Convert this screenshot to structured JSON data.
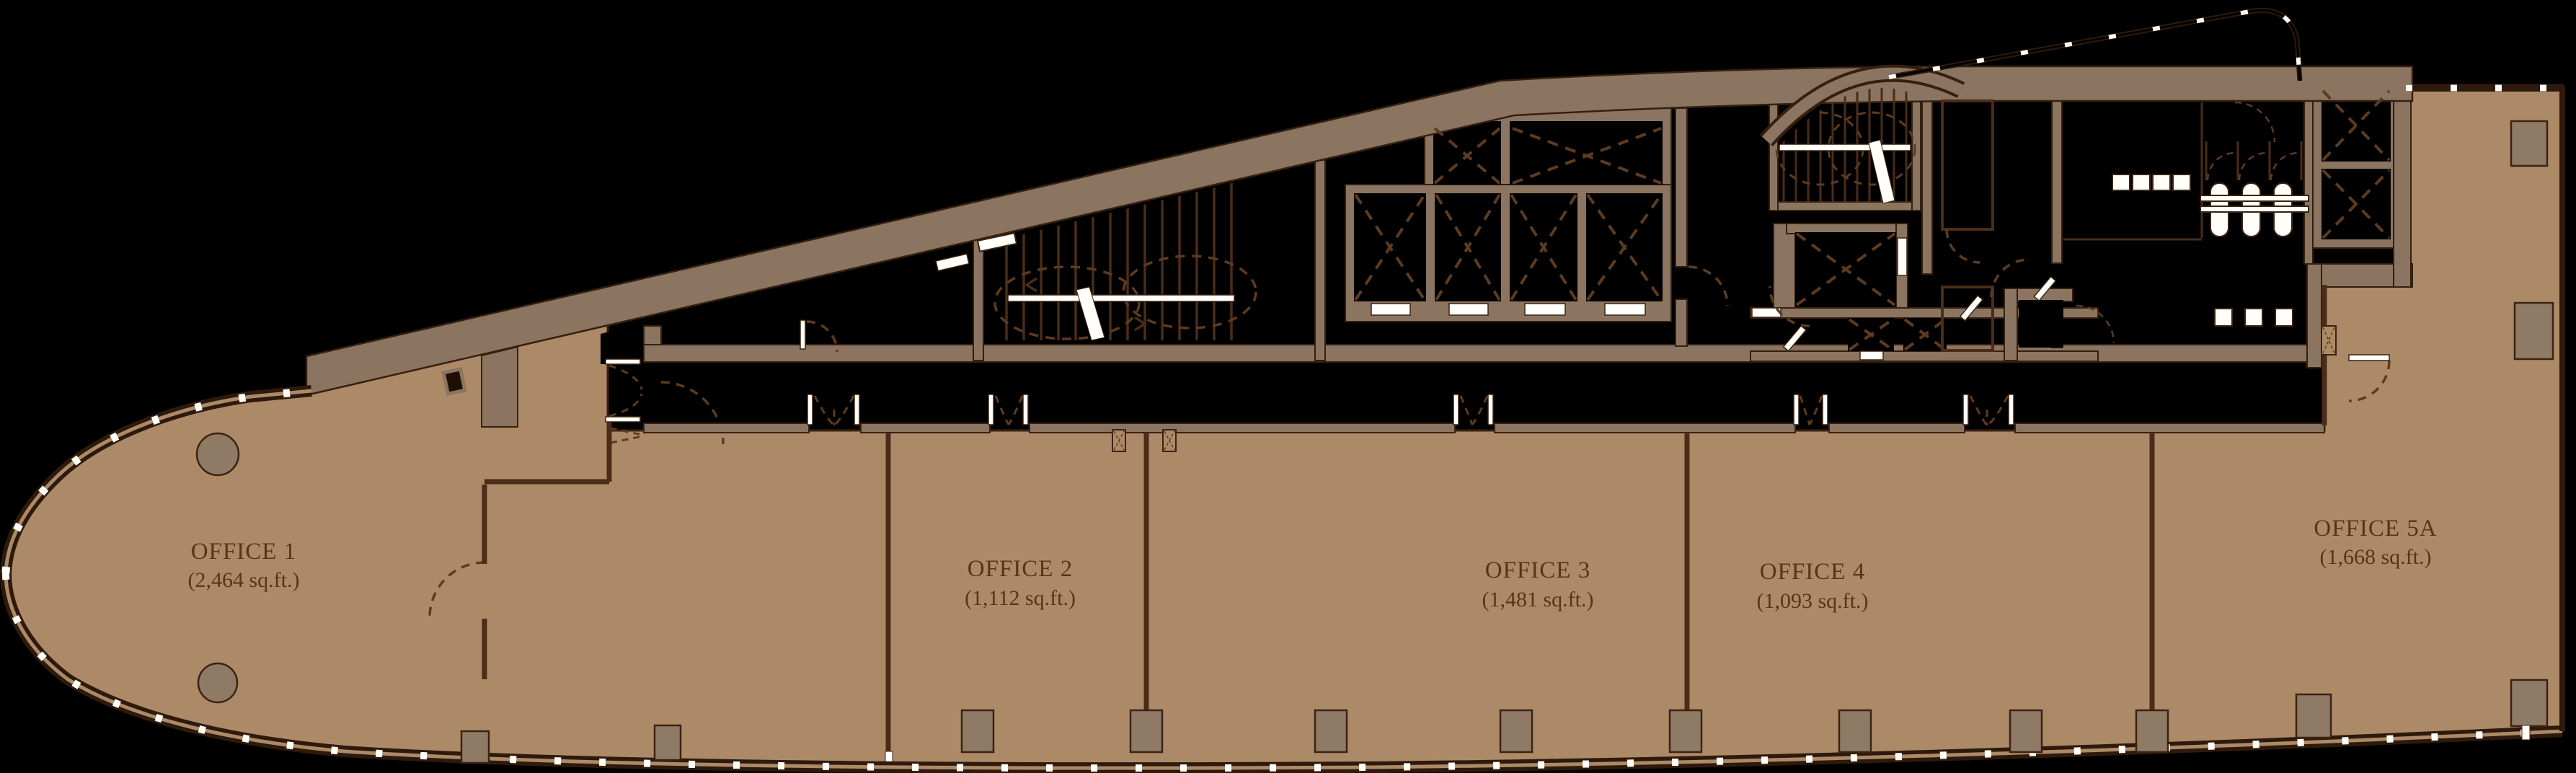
{
  "plan": {
    "title": "Office floor leasing plan",
    "colors": {
      "background": "#000000",
      "floor_tan": "#ad8a67",
      "wall_poche": "#8b7561",
      "line_dark": "#3a2313",
      "column_fill": "#8e7a65",
      "fixture_white": "#fffef9",
      "label_text": "#583419"
    },
    "offices": [
      {
        "id": "office-1",
        "name": "OFFICE 1",
        "area": "(2,464 sq.ft.)"
      },
      {
        "id": "office-2",
        "name": "OFFICE 2",
        "area": "(1,112 sq.ft.)"
      },
      {
        "id": "office-3",
        "name": "OFFICE 3",
        "area": "(1,481 sq.ft.)"
      },
      {
        "id": "office-4",
        "name": "OFFICE 4",
        "area": "(1,093 sq.ft.)"
      },
      {
        "id": "office-5a",
        "name": "OFFICE 5A",
        "area": "(1,668 sq.ft.)"
      }
    ]
  }
}
